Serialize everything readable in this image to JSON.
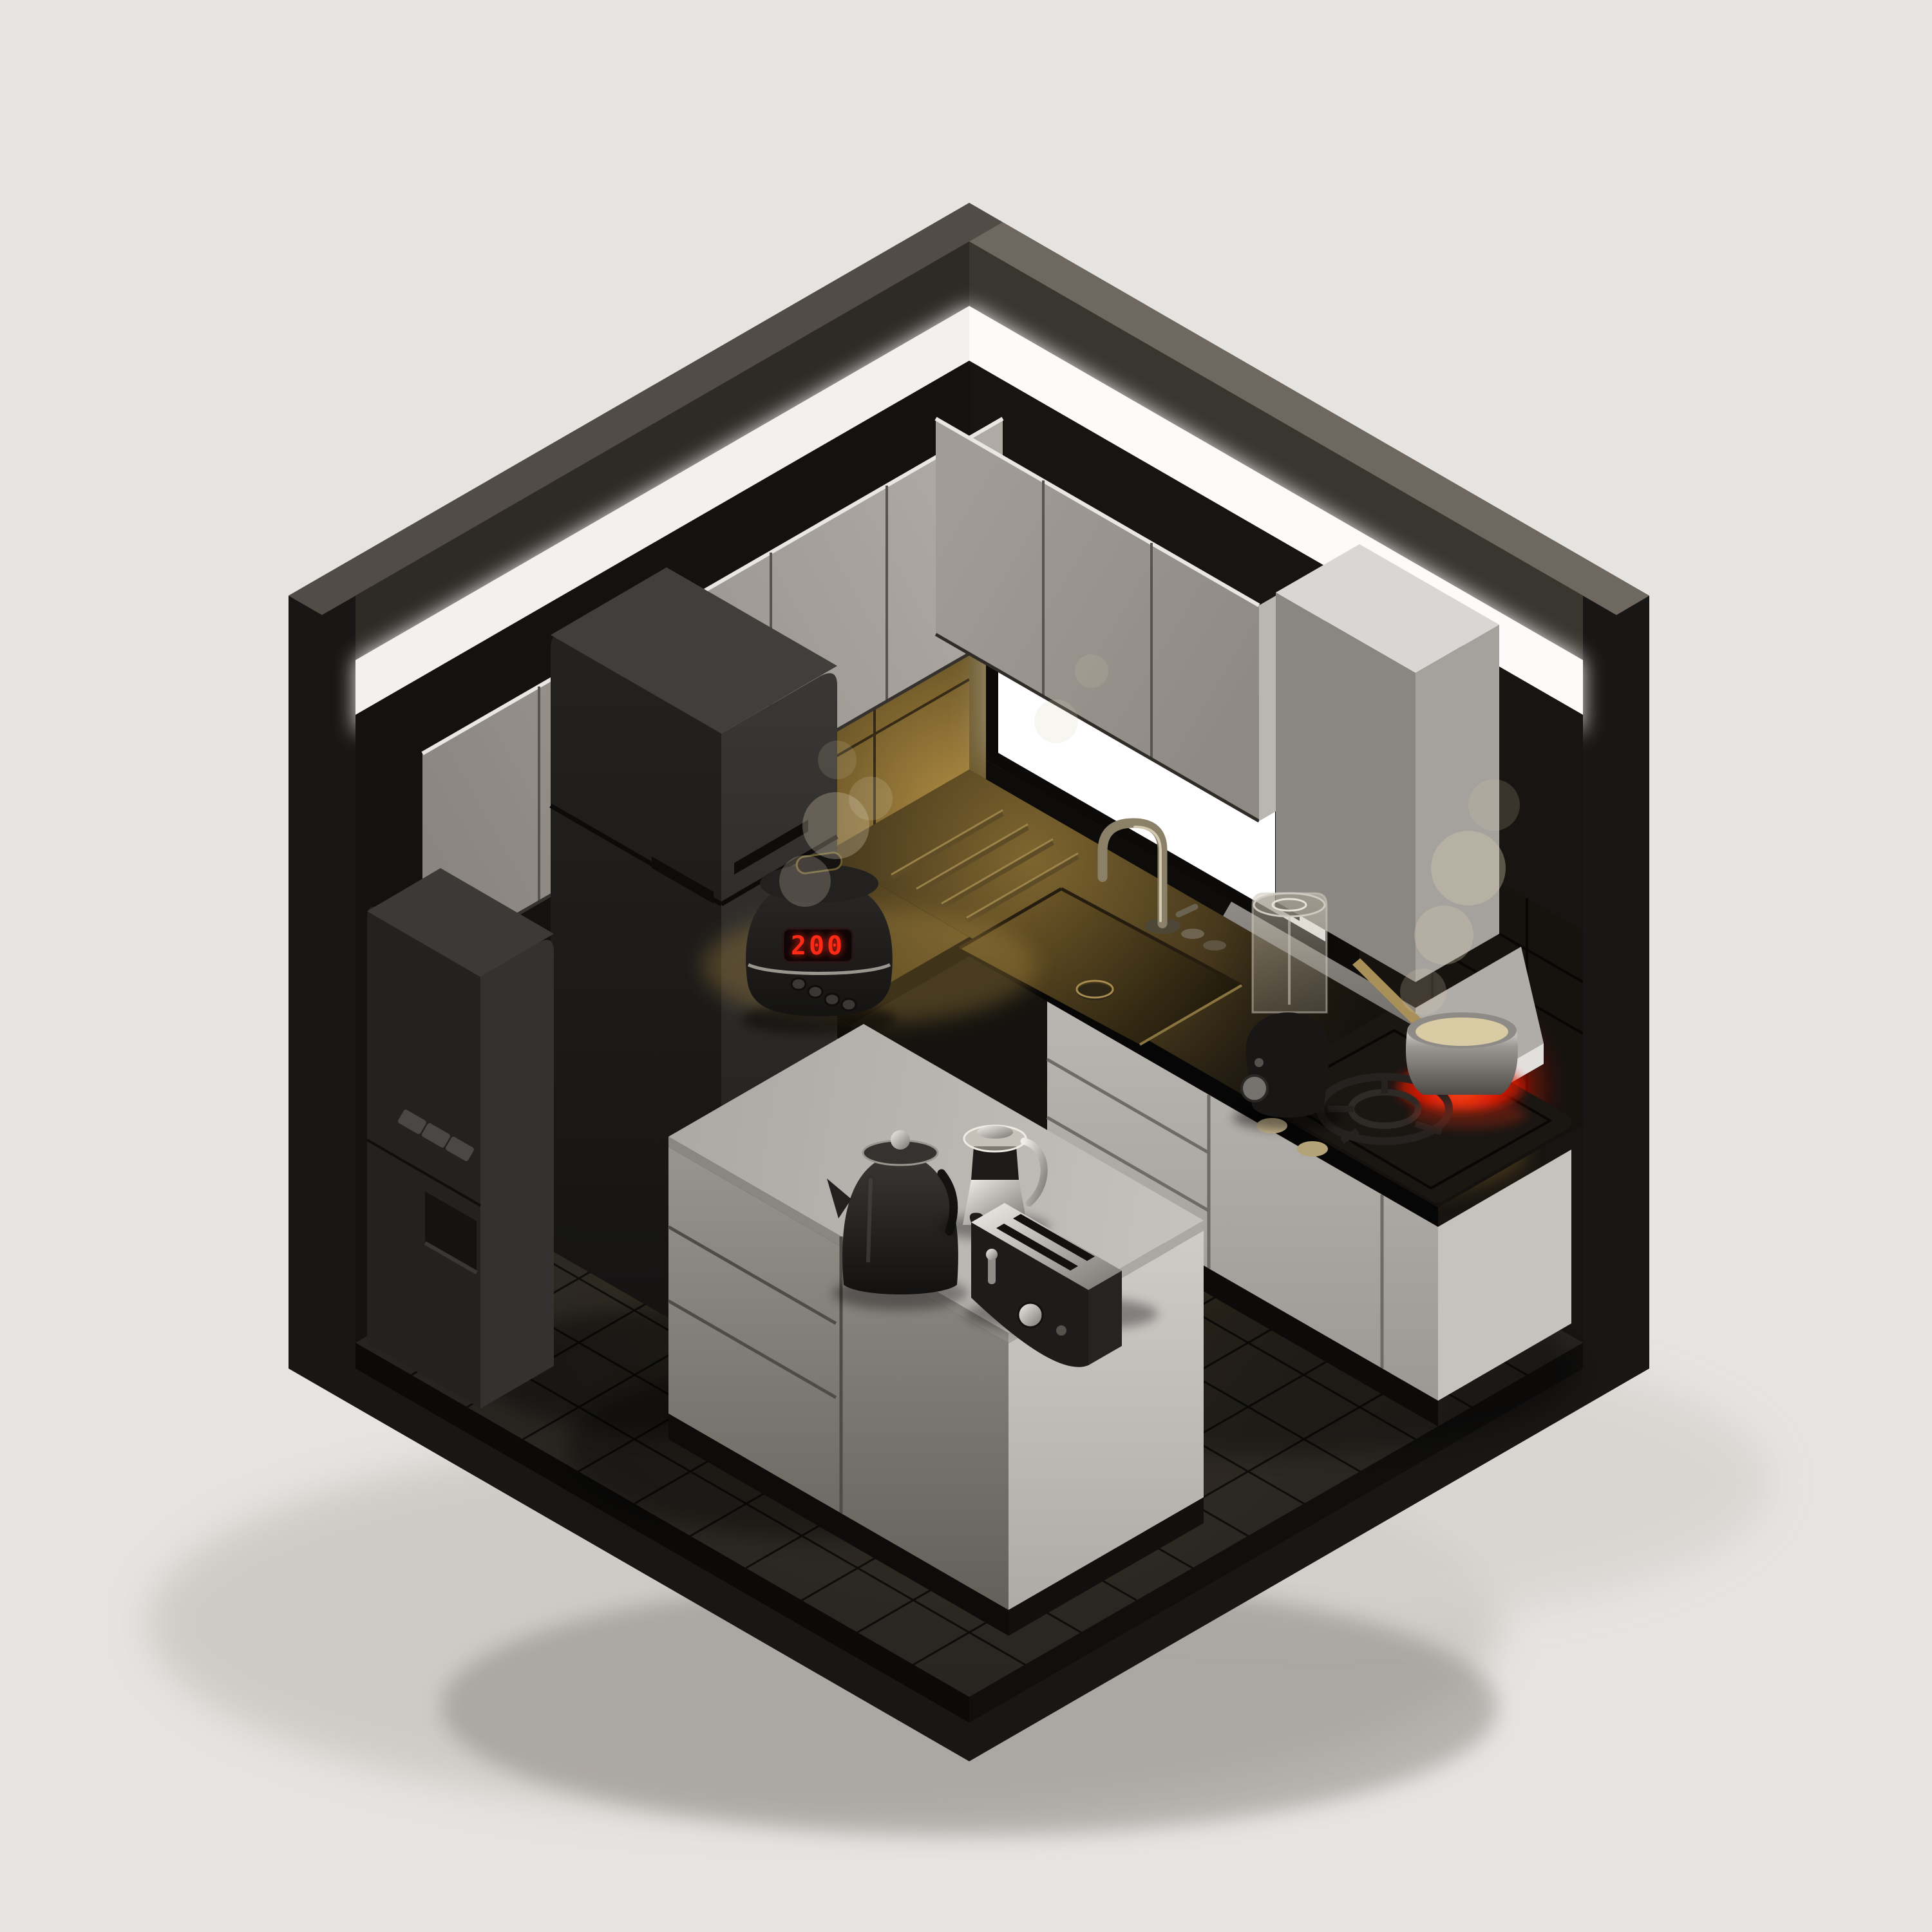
{
  "scene": {
    "kind": "isometric-3d-render",
    "subject": "miniature dark kitchen diorama inside an open cube room",
    "rice_cooker": {
      "display": "200"
    },
    "objects": [
      {
        "name": "ceiling-light",
        "label": "Ceiling light strip",
        "color": "#fcfbf9"
      },
      {
        "name": "upper-cabinets",
        "label": "Upper cabinets",
        "color": "#a49e98"
      },
      {
        "name": "window",
        "label": "Back-lit window",
        "color": "#ffffff"
      },
      {
        "name": "range-hood",
        "label": "Range hood",
        "color": "#a5a19c"
      },
      {
        "name": "fridge",
        "label": "Refrigerator",
        "color": "#232120"
      },
      {
        "name": "water-dispenser",
        "label": "Water dispenser",
        "color": "#2a2826"
      },
      {
        "name": "rice-cooker",
        "label": "Rice cooker",
        "color": "#1c1a19"
      },
      {
        "name": "microwave-oven",
        "label": "Microwave oven",
        "color": "#1f1d1b"
      },
      {
        "name": "kitchen-sink",
        "label": "Sink with faucet",
        "color": "#8a7236"
      },
      {
        "name": "blender",
        "label": "Blender",
        "color": "#191716"
      },
      {
        "name": "gas-cooktop",
        "label": "Cooktop with glowing burner",
        "color": "#e81f08"
      },
      {
        "name": "saucepan",
        "label": "Saucepan on burner",
        "color": "#9b9893"
      },
      {
        "name": "kitchen-island",
        "label": "Kitchen island",
        "color": "#b7b3ae"
      },
      {
        "name": "electric-kettle",
        "label": "Electric kettle",
        "color": "#1d1b1a"
      },
      {
        "name": "coffee-pot",
        "label": "Coffee pot",
        "color": "#cfcac2"
      },
      {
        "name": "toaster",
        "label": "Two-slot toaster",
        "color": "#1e1c1b"
      },
      {
        "name": "tiled-floor",
        "label": "Dark tiled floor",
        "color": "#272422"
      }
    ]
  },
  "palette": {
    "background": "#e6e4e1",
    "shell": "#191715",
    "band_left": "#514c46",
    "band_right": "#6e6861",
    "inner_left": "#2e2a26",
    "inner_right": "#39352f",
    "glow": "#fcfbf9",
    "glow_left": "#f3f1ee",
    "wall_left": "#141210",
    "wall_right": "#171411",
    "floor_grout": "#0b0a09",
    "plinth_right": "#100f0e",
    "plinth_left": "#0b0a09",
    "gold_edge": "#6d5a2e",
    "window_frame": "#0b0a09",
    "window_glass": "#ffffff",
    "cabinet_seam": "#57534e",
    "cabinet_highlight": "#e9e7e4",
    "cabinet_side": "#bab6b1",
    "hood_top": "#d9d7d4",
    "hood_right": "#a5a19c",
    "hood_rim": "#d3d1ce",
    "hood_rim_right": "#e2e0dd",
    "counter_dark": "#14110e",
    "counter_edge": "#070606",
    "backsplash_dark": "#16130f",
    "base_end": "#c6c3bf",
    "niche_frame": "#aeaaa5",
    "niche_dark": "#121110",
    "appliance_black": "#1f1d1b",
    "fridge_top": "#413e3b",
    "dispenser_left": "#242221",
    "dispenser_right": "#343231",
    "dispenser_top": "#3c3937",
    "button_gray": "#4a4744",
    "knob_gray": "#76726d",
    "pot_content": "#d9cba3",
    "pot_handle": "#a98f58",
    "led_red": "#ff2a16",
    "red_glow": "#e81f08",
    "steam": "#d9cdb4",
    "drain": "#2e2718",
    "faucet": "#8a8168",
    "faucet_highlight": "#d9d0b6",
    "groove_dark": "#5e4c26",
    "groove_light": "#a98f52",
    "island_seam": "#4f4b47",
    "island_plinth": "#0d0c0b",
    "wall_tile_grout": "#0e0c0a"
  }
}
